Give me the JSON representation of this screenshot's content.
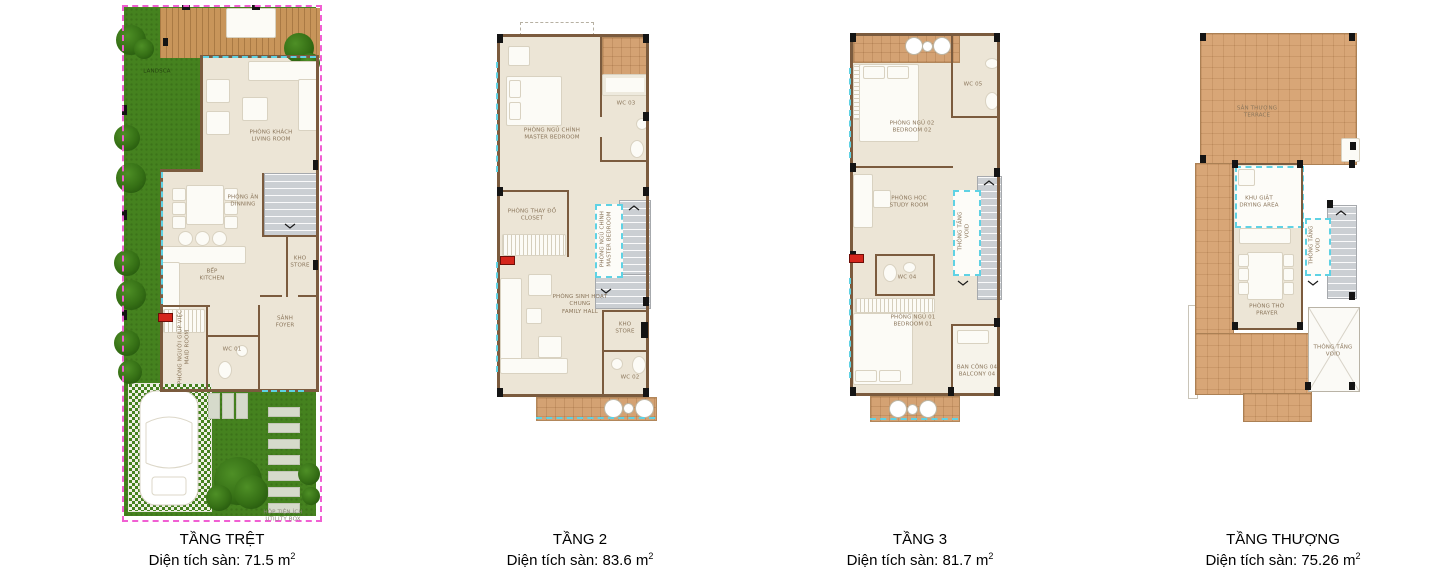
{
  "colors": {
    "wall": "#7b5b3e",
    "room_fill": "#ece5d6",
    "tile": "#d4a273",
    "terrace": "#d8a677",
    "wood_deck": "#c8955a",
    "grass": "#45821f",
    "stairs": "#cbcfd3",
    "glass_cyan": "#5fd2e4",
    "lot_pink": "#f15fd3",
    "marker_red": "#d5261c",
    "label_text": "#8a755a"
  },
  "plans": [
    {
      "title": "TẦNG TRỆT",
      "area": "Diện tích sàn: 71.5 m",
      "area_sup": "2",
      "labels": {
        "landscape": "LANDSCA",
        "living_vn": "PHÒNG KHÁCH",
        "living_en": "LIVING ROOM",
        "dining_vn": "PHÒNG ĂN",
        "dining_en": "DINNING",
        "kitchen_vn": "BẾP",
        "kitchen_en": "KITCHEN",
        "store_vn": "KHO",
        "store_en": "STORE",
        "maid_vn": "PHÒNG NGƯỜI GIÚP VIỆC",
        "maid_en": "MAID ROOM",
        "foyer_vn": "SẢNH",
        "foyer_en": "FOYER",
        "wc01": "WC 01",
        "utility_vn": "HỘP TIỆN ÍCH",
        "utility_en": "UTILITY BOX"
      }
    },
    {
      "title": "TẦNG 2",
      "area": "Diện tích sàn: 83.6 m",
      "area_sup": "2",
      "labels": {
        "master_vn": "PHÒNG NGỦ CHÍNH",
        "master_en": "MASTER BEDROOM",
        "wc03": "WC 03",
        "closet_vn": "PHÒNG THAY ĐỒ",
        "closet_en": "CLOSET",
        "void_vn": "PHÒNG NGỦ CHÍNH",
        "void_en": "MASTER BEDROOM",
        "family_vn": "PHÒNG SINH HOẠT CHUNG",
        "family_en": "FAMILY HALL",
        "store_vn": "KHO",
        "store_en": "STORE",
        "wc02": "WC 02"
      }
    },
    {
      "title": "TẦNG 3",
      "area": "Diện tích sàn: 81.7 m",
      "area_sup": "2",
      "labels": {
        "bedroom02_vn": "PHÒNG NGỦ 02",
        "bedroom02_en": "BEDROOM 02",
        "wc05": "WC 05",
        "study_vn": "PHÒNG HỌC",
        "study_en": "STUDY ROOM",
        "void_vn": "THÔNG TẦNG",
        "void_en": "VOID",
        "wc04": "WC 04",
        "bedroom01_vn": "PHÒNG NGỦ 01",
        "bedroom01_en": "BEDROOM 01",
        "balcony04_vn": "BAN CÔNG 04",
        "balcony04_en": "BALCONY 04"
      }
    },
    {
      "title": "TẦNG THƯỢNG",
      "area": "Diện tích sàn: 75.26 m",
      "area_sup": "2",
      "labels": {
        "terrace_vn": "SÂN THƯỢNG",
        "terrace_en": "TERRACE",
        "drying_vn": "KHU GIẶT",
        "drying_en": "DRYING AREA",
        "prayer_vn": "PHÒNG THỜ",
        "prayer_en": "PRAYER",
        "void1_vn": "THÔNG TẦNG",
        "void1_en": "VOID",
        "void2_vn": "THÔNG TẦNG",
        "void2_en": "VOID"
      }
    }
  ]
}
